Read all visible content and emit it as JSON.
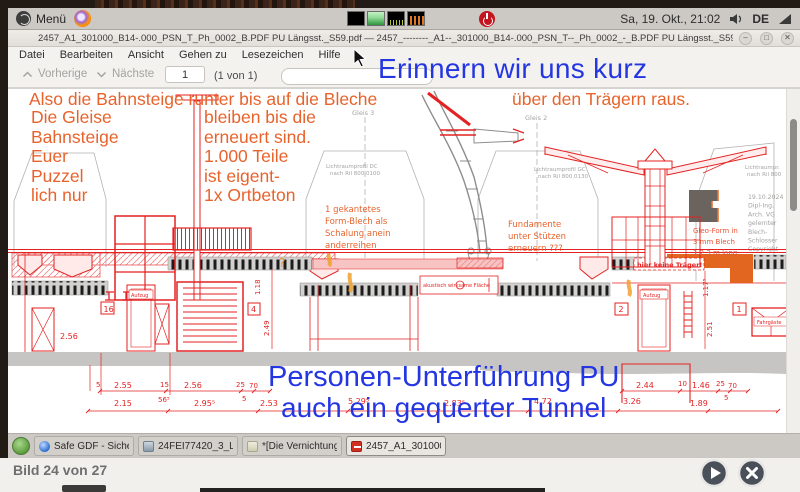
{
  "panel": {
    "menu_label": "Menü",
    "clock": "Sa, 19. Okt., 21:02",
    "keyboard_layout": "DE"
  },
  "icons": {
    "minimize": "–",
    "maximize": "□",
    "close": "✕"
  },
  "window": {
    "title": "2457_A1_301000_B14-.000_PSN_T_Ph_0002_B.PDF PU Längsst._S59.pdf — 2457_--------_A1--_301000_B14-.000_PSN_T--_Ph_0002_-_B.PDF PU Längsst._S59",
    "menus": [
      "Datei",
      "Bearbeiten",
      "Ansicht",
      "Gehen zu",
      "Lesezeichen",
      "Hilfe"
    ],
    "toolbar": {
      "prev": "Vorherige",
      "next": "Nächste",
      "page_value": "1",
      "page_of": "(1 von 1)"
    }
  },
  "annotations": {
    "blue_top": "Erinnern wir uns kurz",
    "blue_bottom1": "Personen-Unterführung PU",
    "blue_bottom2": "auch ein gequerter Tunnel",
    "orange_top_left": "Also die Bahnsteige runter bis auf die Bleche",
    "orange_top_right": "über den Trägern raus.",
    "orange_col1": [
      "Die Gleise",
      "Bahnsteige",
      "Euer",
      "Puzzel",
      "lich nur"
    ],
    "orange_col2": [
      "bleiben bis die",
      "erneuert sind.",
      "1.000 Teile",
      "ist eigent-",
      "1x Ortbeton"
    ]
  },
  "drawing": {
    "gleis3": "Gleis 3",
    "gleis2": "Gleis 2",
    "lichtraum_left": [
      "Lichtraumprofil DC",
      "nach Ril 800.0100"
    ],
    "lichtraum_mid": [
      "Lichtraumprofil GC",
      "nach Ril 800.0130"
    ],
    "lichtraum_right": [
      "Lichtraumpr.",
      "nach Ril 800"
    ],
    "stamp": [
      "19.10.2024",
      "Dipl-Ing.",
      "Arch. VG",
      "gelernter",
      "Blech-",
      "Schlosser",
      "Copyright"
    ],
    "note_formblech": [
      "1 gekantetes",
      "Form-Blech als",
      "Schalung anein",
      "anderreihen"
    ],
    "note_fundamente": [
      "Fundamente",
      "unter Stützen",
      "erneuern ???"
    ],
    "note_gleoform": [
      "Gleo-Form in",
      "3 mm Blech",
      "1.2.3 m lang"
    ],
    "note_traeger": "hier keine Träger!",
    "note_akustik": "akustisch wirksame Fläche",
    "question_mark": "?",
    "label_aufzug": "Aufzug",
    "label_fahrgaeste": "Fahrgäste",
    "boxed": [
      "16",
      "4",
      "2",
      "1"
    ],
    "vdims": [
      "1.18",
      "2.49",
      "1.17⁵",
      "2.51"
    ],
    "dim_left": "2.56",
    "dim_upper_left": [
      "5",
      "2.55",
      "15",
      "2.56",
      "25",
      "70",
      "5"
    ],
    "dim_upper_right": [
      "2.44",
      "10",
      "1.46",
      "25",
      "70",
      "5"
    ],
    "dim_lower": [
      "2.15",
      "56⁵",
      "2.95⁵",
      "2.53",
      "5.29⁵",
      "2.83⁵",
      "4.72",
      "3.26",
      "1.89"
    ]
  },
  "taskbar": {
    "items": [
      {
        "label": "Safe GDF - Sicheres E..."
      },
      {
        "label": "24FEI77420_3_LeiB-1..."
      },
      {
        "label": "*[Die Vernichtung der..."
      },
      {
        "label": "2457_A1_301000_B14..."
      }
    ]
  },
  "viewer": {
    "status": "Bild 24 von 27"
  }
}
